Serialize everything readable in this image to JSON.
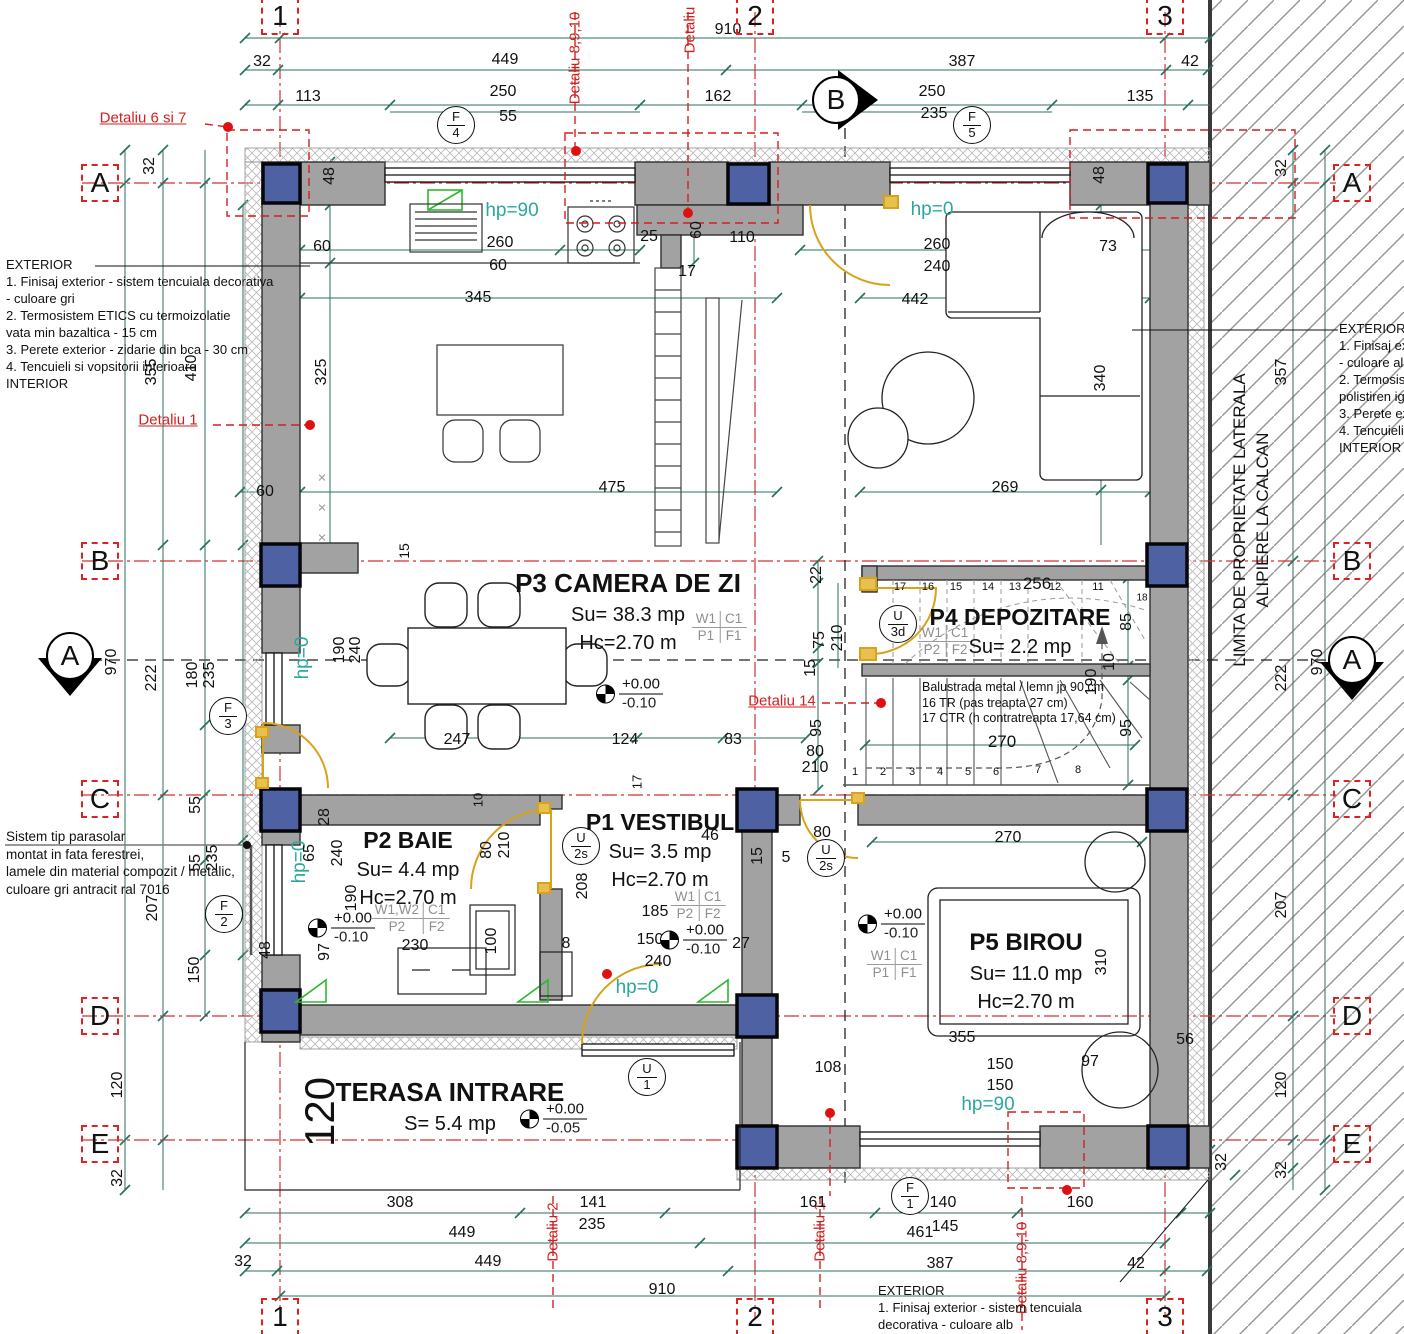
{
  "drawing": {
    "colors": {
      "wall": "#a2a2a2",
      "column": "#4e61a3",
      "dim_line": "#2a7162",
      "teal_text": "#2ba89b",
      "detail_red": "#d21f1f"
    },
    "rooms": {
      "p3": {
        "title": "P3 CAMERA DE ZI",
        "su": "Su= 38.3 mp",
        "hc": "Hc=2.70 m"
      },
      "p4": {
        "title": "P4 DEPOZITARE",
        "su": "Su= 2.2 mp"
      },
      "p2": {
        "title": "P2 BAIE",
        "su": "Su= 4.4 mp",
        "hc": "Hc=2.70 m"
      },
      "p1": {
        "title": "P1 VESTIBUL",
        "su": "Su= 3.5 mp",
        "hc": "Hc=2.70 m"
      },
      "p5": {
        "title": "P5 BIROU",
        "su": "Su= 11.0 mp",
        "hc": "Hc=2.70 m"
      },
      "terasa": {
        "title": "TERASA INTRARE",
        "su": "S= 5.4 mp"
      }
    },
    "property_line": {
      "line1": "LIMITA DE PROPRIETATE LATERALA",
      "line2": "ALIPIERE LA CALCAN"
    },
    "note_blocks": [
      {
        "n": "exterior-note-left",
        "x": 6,
        "y": 256,
        "lh": 17,
        "fs": 13,
        "lines": [
          "EXTERIOR",
          "1. Finisaj exterior - sistem tencuiala decorativa",
          "- culoare gri",
          "2. Termosistem ETICS cu termoizolatie",
          "vata min bazaltica - 15 cm",
          "3. Perete exterior - zidarie din bca - 30 cm",
          "4. Tencuieli si vopsitorii interioare",
          " INTERIOR"
        ]
      },
      {
        "n": "exterior-note-right",
        "x": 1339,
        "y": 320,
        "lh": 17,
        "fs": 13,
        "lines": [
          "EXTERIOR",
          "1. Finisaj exte",
          "- culoare alb",
          "2. Termosiste",
          "polistiren ignif",
          "3. Perete exte",
          "4. Tencuieli s",
          " INTERIOR"
        ]
      },
      {
        "n": "parasolar-note",
        "x": 6,
        "y": 828,
        "lh": 17.5,
        "fs": 13.5,
        "lines": [
          "Sistem tip parasolar",
          "montat in fata ferestrei,",
          "lamele din material compozit / metalic,",
          "culoare gri antracit ral 7016"
        ]
      },
      {
        "n": "exterior-note-bottom",
        "x": 878,
        "y": 1282,
        "lh": 17,
        "fs": 13,
        "lines": [
          "EXTERIOR",
          "1. Finisaj exterior - sistem tencuiala",
          "decorativa - culoare alb"
        ]
      },
      {
        "n": "balustrade-note",
        "x": 922,
        "y": 680,
        "lh": 15.5,
        "fs": 12.5,
        "lines": [
          "Balustrada metal / lemn jp 90 cm",
          "16 TR (pas treapta 27 cm)",
          "17 CTR (h contratreapta 17,64 cm)"
        ]
      }
    ],
    "grid_markers": [
      {
        "t": "1",
        "x": 280,
        "y": 16
      },
      {
        "t": "2",
        "x": 755,
        "y": 16
      },
      {
        "t": "3",
        "x": 1165,
        "y": 16
      },
      {
        "t": "1",
        "x": 280,
        "y": 1317
      },
      {
        "t": "2",
        "x": 755,
        "y": 1317
      },
      {
        "t": "3",
        "x": 1165,
        "y": 1317
      },
      {
        "t": "A",
        "x": 100,
        "y": 183
      },
      {
        "t": "B",
        "x": 100,
        "y": 561
      },
      {
        "t": "C",
        "x": 100,
        "y": 799
      },
      {
        "t": "D",
        "x": 100,
        "y": 1016
      },
      {
        "t": "E",
        "x": 100,
        "y": 1144
      },
      {
        "t": "A",
        "x": 1352,
        "y": 183
      },
      {
        "t": "B",
        "x": 1352,
        "y": 561
      },
      {
        "t": "C",
        "x": 1352,
        "y": 799
      },
      {
        "t": "D",
        "x": 1352,
        "y": 1016
      },
      {
        "t": "E",
        "x": 1352,
        "y": 1144
      }
    ],
    "section_markers": [
      {
        "t": "A",
        "x": 70,
        "y": 656,
        "dir": "down"
      },
      {
        "t": "A",
        "x": 1352,
        "y": 660,
        "dir": "down"
      },
      {
        "t": "B",
        "x": 836,
        "y": 100,
        "dir": "right"
      }
    ],
    "window_tags": [
      {
        "top": "F",
        "bot": "4",
        "x": 456,
        "y": 125
      },
      {
        "top": "F",
        "bot": "5",
        "x": 972,
        "y": 125
      },
      {
        "top": "F",
        "bot": "3",
        "x": 228,
        "y": 716
      },
      {
        "top": "F",
        "bot": "2",
        "x": 224,
        "y": 914
      },
      {
        "top": "F",
        "bot": "1",
        "x": 910,
        "y": 1196
      },
      {
        "top": "U",
        "bot": "1",
        "x": 647,
        "y": 1077
      },
      {
        "top": "U",
        "bot": "2s",
        "x": 581,
        "y": 846
      },
      {
        "top": "U",
        "bot": "2s",
        "x": 826,
        "y": 858
      },
      {
        "top": "U",
        "bot": "3d",
        "x": 898,
        "y": 624
      }
    ],
    "level_markers": [
      {
        "plus": "+0.00",
        "minus": "-0.10",
        "x": 596,
        "y": 694
      },
      {
        "plus": "+0.00",
        "minus": "-0.10",
        "x": 308,
        "y": 928
      },
      {
        "plus": "+0.00",
        "minus": "-0.10",
        "x": 660,
        "y": 940
      },
      {
        "plus": "+0.00",
        "minus": "-0.10",
        "x": 858,
        "y": 924
      },
      {
        "plus": "+0.00",
        "minus": "-0.05",
        "x": 520,
        "y": 1119
      }
    ],
    "finish_tables": [
      {
        "a": "W1",
        "b": "C1",
        "c": "P1",
        "d": "F1",
        "x": 719,
        "y": 627
      },
      {
        "a": "W1",
        "b": "C1",
        "c": "P2",
        "d": "F2",
        "x": 945,
        "y": 641
      },
      {
        "a": "W1,W2",
        "b": "C1",
        "c": "P2",
        "d": "F2",
        "x": 410,
        "y": 918
      },
      {
        "a": "W1",
        "b": "C1",
        "c": "P2",
        "d": "F2",
        "x": 698,
        "y": 905
      },
      {
        "a": "W1",
        "b": "C1",
        "c": "P1",
        "d": "F1",
        "x": 894,
        "y": 964
      }
    ],
    "dim_labels": [
      {
        "t": "910",
        "x": 728,
        "y": 30
      },
      {
        "t": "32",
        "x": 262,
        "y": 62
      },
      {
        "t": "449",
        "x": 505,
        "y": 60
      },
      {
        "t": "387",
        "x": 962,
        "y": 62
      },
      {
        "t": "42",
        "x": 1190,
        "y": 62
      },
      {
        "t": "113",
        "x": 308,
        "y": 97
      },
      {
        "t": "250",
        "x": 503,
        "y": 92
      },
      {
        "t": "55",
        "x": 508,
        "y": 117
      },
      {
        "t": "162",
        "x": 718,
        "y": 97
      },
      {
        "t": "250",
        "x": 932,
        "y": 92
      },
      {
        "t": "235",
        "x": 934,
        "y": 114
      },
      {
        "t": "135",
        "x": 1140,
        "y": 97
      },
      {
        "t": "Detaliu 8,9,10",
        "x": 575,
        "y": 58,
        "r": 1,
        "c": "red",
        "s": 15
      },
      {
        "t": "Detaliu",
        "x": 690,
        "y": 30,
        "r": 1,
        "c": "red",
        "s": 15
      },
      {
        "t": "Detaliu 6 si 7",
        "x": 143,
        "y": 118,
        "c": "red underline",
        "s": 15
      },
      {
        "t": "Detaliu 1",
        "x": 168,
        "y": 420,
        "c": "red underline",
        "s": 15
      },
      {
        "t": "Detaliu 14",
        "x": 782,
        "y": 701,
        "c": "red underline",
        "s": 15
      },
      {
        "t": "Detaliu 2",
        "x": 553,
        "y": 1232,
        "r": 1,
        "c": "red",
        "s": 15
      },
      {
        "t": "Detaliu 1",
        "x": 820,
        "y": 1232,
        "r": 1,
        "c": "red",
        "s": 15
      },
      {
        "t": "Detaliu 8,9,10",
        "x": 1022,
        "y": 1268,
        "r": 1,
        "c": "red",
        "s": 15
      },
      {
        "t": "970",
        "x": 112,
        "y": 662,
        "r": 1
      },
      {
        "t": "120",
        "x": 118,
        "y": 1085,
        "r": 1
      },
      {
        "t": "32",
        "x": 118,
        "y": 1178,
        "r": 1
      },
      {
        "t": "32",
        "x": 150,
        "y": 166,
        "r": 1
      },
      {
        "t": "355",
        "x": 152,
        "y": 372,
        "r": 1
      },
      {
        "t": "222",
        "x": 152,
        "y": 678,
        "r": 1
      },
      {
        "t": "207",
        "x": 153,
        "y": 908,
        "r": 1
      },
      {
        "t": "410",
        "x": 192,
        "y": 368,
        "r": 1
      },
      {
        "t": "180",
        "x": 193,
        "y": 675,
        "r": 1
      },
      {
        "t": "235",
        "x": 210,
        "y": 675,
        "r": 1
      },
      {
        "t": "55",
        "x": 196,
        "y": 805,
        "r": 1
      },
      {
        "t": "55",
        "x": 196,
        "y": 863,
        "r": 1
      },
      {
        "t": "235",
        "x": 213,
        "y": 858,
        "r": 1
      },
      {
        "t": "150",
        "x": 195,
        "y": 970,
        "r": 1
      },
      {
        "t": "48",
        "x": 266,
        "y": 950,
        "r": 1
      },
      {
        "t": "32",
        "x": 1282,
        "y": 168,
        "r": 1
      },
      {
        "t": "357",
        "x": 1282,
        "y": 372,
        "r": 1
      },
      {
        "t": "222",
        "x": 1282,
        "y": 678,
        "r": 1
      },
      {
        "t": "970",
        "x": 1318,
        "y": 662,
        "r": 1
      },
      {
        "t": "207",
        "x": 1282,
        "y": 905,
        "r": 1
      },
      {
        "t": "120",
        "x": 1282,
        "y": 1085,
        "r": 1
      },
      {
        "t": "32",
        "x": 1282,
        "y": 1170,
        "r": 1
      },
      {
        "t": "32",
        "x": 1222,
        "y": 1162,
        "r": 1
      },
      {
        "t": "48",
        "x": 330,
        "y": 176,
        "r": 1
      },
      {
        "t": "60",
        "x": 322,
        "y": 247
      },
      {
        "t": "260",
        "x": 500,
        "y": 243
      },
      {
        "t": "60",
        "x": 498,
        "y": 266
      },
      {
        "t": "25",
        "x": 649,
        "y": 237
      },
      {
        "t": "60",
        "x": 697,
        "y": 230,
        "r": 1
      },
      {
        "t": "17",
        "x": 687,
        "y": 272
      },
      {
        "t": "110",
        "x": 742,
        "y": 238
      },
      {
        "t": "345",
        "x": 478,
        "y": 298
      },
      {
        "t": "325",
        "x": 322,
        "y": 372,
        "r": 1
      },
      {
        "t": "48",
        "x": 1100,
        "y": 175,
        "r": 1
      },
      {
        "t": "260",
        "x": 937,
        "y": 245
      },
      {
        "t": "240",
        "x": 937,
        "y": 267
      },
      {
        "t": "73",
        "x": 1108,
        "y": 247
      },
      {
        "t": "442",
        "x": 915,
        "y": 300
      },
      {
        "t": "340",
        "x": 1101,
        "y": 378,
        "r": 1
      },
      {
        "t": "60",
        "x": 265,
        "y": 492
      },
      {
        "t": "475",
        "x": 612,
        "y": 488
      },
      {
        "t": "269",
        "x": 1005,
        "y": 488
      },
      {
        "t": "15",
        "x": 404,
        "y": 551,
        "r": 1,
        "s": 14
      },
      {
        "t": "190",
        "x": 340,
        "y": 650,
        "r": 1
      },
      {
        "t": "240",
        "x": 356,
        "y": 650,
        "r": 1
      },
      {
        "t": "hp=90",
        "x": 512,
        "y": 211,
        "c": "teal"
      },
      {
        "t": "hp=0",
        "x": 932,
        "y": 210,
        "c": "teal"
      },
      {
        "t": "hp=0",
        "x": 303,
        "y": 658,
        "r": 1,
        "c": "teal"
      },
      {
        "t": "hp=0",
        "x": 300,
        "y": 862,
        "r": 1,
        "c": "teal"
      },
      {
        "t": "hp=0",
        "x": 637,
        "y": 988,
        "c": "teal"
      },
      {
        "t": "hp=90",
        "x": 988,
        "y": 1105,
        "c": "teal"
      },
      {
        "t": "×",
        "x": 322,
        "y": 478,
        "c": "gray",
        "s": 15
      },
      {
        "t": "×",
        "x": 322,
        "y": 508,
        "c": "gray",
        "s": 15
      },
      {
        "t": "×",
        "x": 322,
        "y": 538,
        "c": "gray",
        "s": 15
      },
      {
        "t": "22",
        "x": 817,
        "y": 575,
        "r": 1
      },
      {
        "t": "256",
        "x": 1037,
        "y": 584,
        "s": 17
      },
      {
        "t": "17",
        "x": 900,
        "y": 587,
        "s": 11
      },
      {
        "t": "16",
        "x": 928,
        "y": 587,
        "s": 11
      },
      {
        "t": "15",
        "x": 956,
        "y": 587,
        "s": 11
      },
      {
        "t": "14",
        "x": 988,
        "y": 587,
        "s": 11
      },
      {
        "t": "13",
        "x": 1015,
        "y": 587,
        "s": 11
      },
      {
        "t": "12",
        "x": 1055,
        "y": 587,
        "s": 11
      },
      {
        "t": "11",
        "x": 1098,
        "y": 587,
        "s": 11
      },
      {
        "t": "18",
        "x": 1142,
        "y": 598,
        "s": 10
      },
      {
        "t": "75",
        "x": 820,
        "y": 640,
        "r": 1
      },
      {
        "t": "210",
        "x": 838,
        "y": 638,
        "r": 1
      },
      {
        "t": "15",
        "x": 811,
        "y": 668,
        "r": 1
      },
      {
        "t": "95",
        "x": 817,
        "y": 728,
        "r": 1
      },
      {
        "t": "80",
        "x": 815,
        "y": 752
      },
      {
        "t": "210",
        "x": 815,
        "y": 768
      },
      {
        "t": "85",
        "x": 1127,
        "y": 622,
        "r": 1
      },
      {
        "t": "190",
        "x": 1092,
        "y": 682,
        "r": 1
      },
      {
        "t": "10",
        "x": 1110,
        "y": 662,
        "r": 1
      },
      {
        "t": "95",
        "x": 1127,
        "y": 728,
        "r": 1
      },
      {
        "t": "270",
        "x": 1002,
        "y": 742,
        "s": 17
      },
      {
        "t": "270",
        "x": 1008,
        "y": 838
      },
      {
        "t": "1",
        "x": 855,
        "y": 772,
        "s": 11
      },
      {
        "t": "2",
        "x": 883,
        "y": 772,
        "s": 11
      },
      {
        "t": "3",
        "x": 912,
        "y": 772,
        "s": 11
      },
      {
        "t": "4",
        "x": 940,
        "y": 772,
        "s": 11
      },
      {
        "t": "5",
        "x": 968,
        "y": 772,
        "s": 11
      },
      {
        "t": "6",
        "x": 996,
        "y": 772,
        "s": 11
      },
      {
        "t": "7",
        "x": 1038,
        "y": 770,
        "s": 11
      },
      {
        "t": "8",
        "x": 1078,
        "y": 770,
        "s": 11
      },
      {
        "t": "247",
        "x": 457,
        "y": 740
      },
      {
        "t": "124",
        "x": 625,
        "y": 740
      },
      {
        "t": "83",
        "x": 733,
        "y": 740
      },
      {
        "t": "17",
        "x": 637,
        "y": 782,
        "r": 1,
        "s": 13
      },
      {
        "t": "28",
        "x": 325,
        "y": 817,
        "r": 1
      },
      {
        "t": "65",
        "x": 310,
        "y": 853,
        "r": 1
      },
      {
        "t": "240",
        "x": 338,
        "y": 853,
        "r": 1
      },
      {
        "t": "190",
        "x": 352,
        "y": 898,
        "r": 1
      },
      {
        "t": "97",
        "x": 325,
        "y": 952,
        "r": 1
      },
      {
        "t": "230",
        "x": 415,
        "y": 946
      },
      {
        "t": "100",
        "x": 492,
        "y": 941,
        "r": 1
      },
      {
        "t": "80",
        "x": 487,
        "y": 850,
        "r": 1
      },
      {
        "t": "210",
        "x": 505,
        "y": 845,
        "r": 1
      },
      {
        "t": "208",
        "x": 583,
        "y": 886,
        "r": 1
      },
      {
        "t": "8",
        "x": 566,
        "y": 944
      },
      {
        "t": "10",
        "x": 478,
        "y": 800,
        "r": 1,
        "s": 13
      },
      {
        "t": "46",
        "x": 710,
        "y": 836
      },
      {
        "t": "185",
        "x": 655,
        "y": 912
      },
      {
        "t": "150",
        "x": 650,
        "y": 940
      },
      {
        "t": "240",
        "x": 658,
        "y": 962
      },
      {
        "t": "27",
        "x": 741,
        "y": 944
      },
      {
        "t": "15",
        "x": 758,
        "y": 856,
        "r": 1
      },
      {
        "t": "5",
        "x": 786,
        "y": 858
      },
      {
        "t": "80",
        "x": 822,
        "y": 833
      },
      {
        "t": "310",
        "x": 1102,
        "y": 962,
        "r": 1
      },
      {
        "t": "355",
        "x": 962,
        "y": 1038
      },
      {
        "t": "56",
        "x": 1185,
        "y": 1040
      },
      {
        "t": "97",
        "x": 1090,
        "y": 1062
      },
      {
        "t": "108",
        "x": 828,
        "y": 1068
      },
      {
        "t": "150",
        "x": 1000,
        "y": 1065
      },
      {
        "t": "150",
        "x": 1000,
        "y": 1086
      },
      {
        "t": "120",
        "x": 320,
        "y": 1112,
        "r": 1,
        "s": 42
      },
      {
        "t": "308",
        "x": 400,
        "y": 1203
      },
      {
        "t": "141",
        "x": 593,
        "y": 1203
      },
      {
        "t": "235",
        "x": 592,
        "y": 1225
      },
      {
        "t": "161",
        "x": 813,
        "y": 1203
      },
      {
        "t": "140",
        "x": 943,
        "y": 1203
      },
      {
        "t": "145",
        "x": 945,
        "y": 1227
      },
      {
        "t": "160",
        "x": 1080,
        "y": 1203
      },
      {
        "t": "449",
        "x": 462,
        "y": 1233
      },
      {
        "t": "461",
        "x": 920,
        "y": 1233
      },
      {
        "t": "32",
        "x": 243,
        "y": 1262
      },
      {
        "t": "449",
        "x": 488,
        "y": 1262
      },
      {
        "t": "387",
        "x": 940,
        "y": 1264
      },
      {
        "t": "42",
        "x": 1136,
        "y": 1264
      },
      {
        "t": "910",
        "x": 662,
        "y": 1290
      }
    ]
  }
}
